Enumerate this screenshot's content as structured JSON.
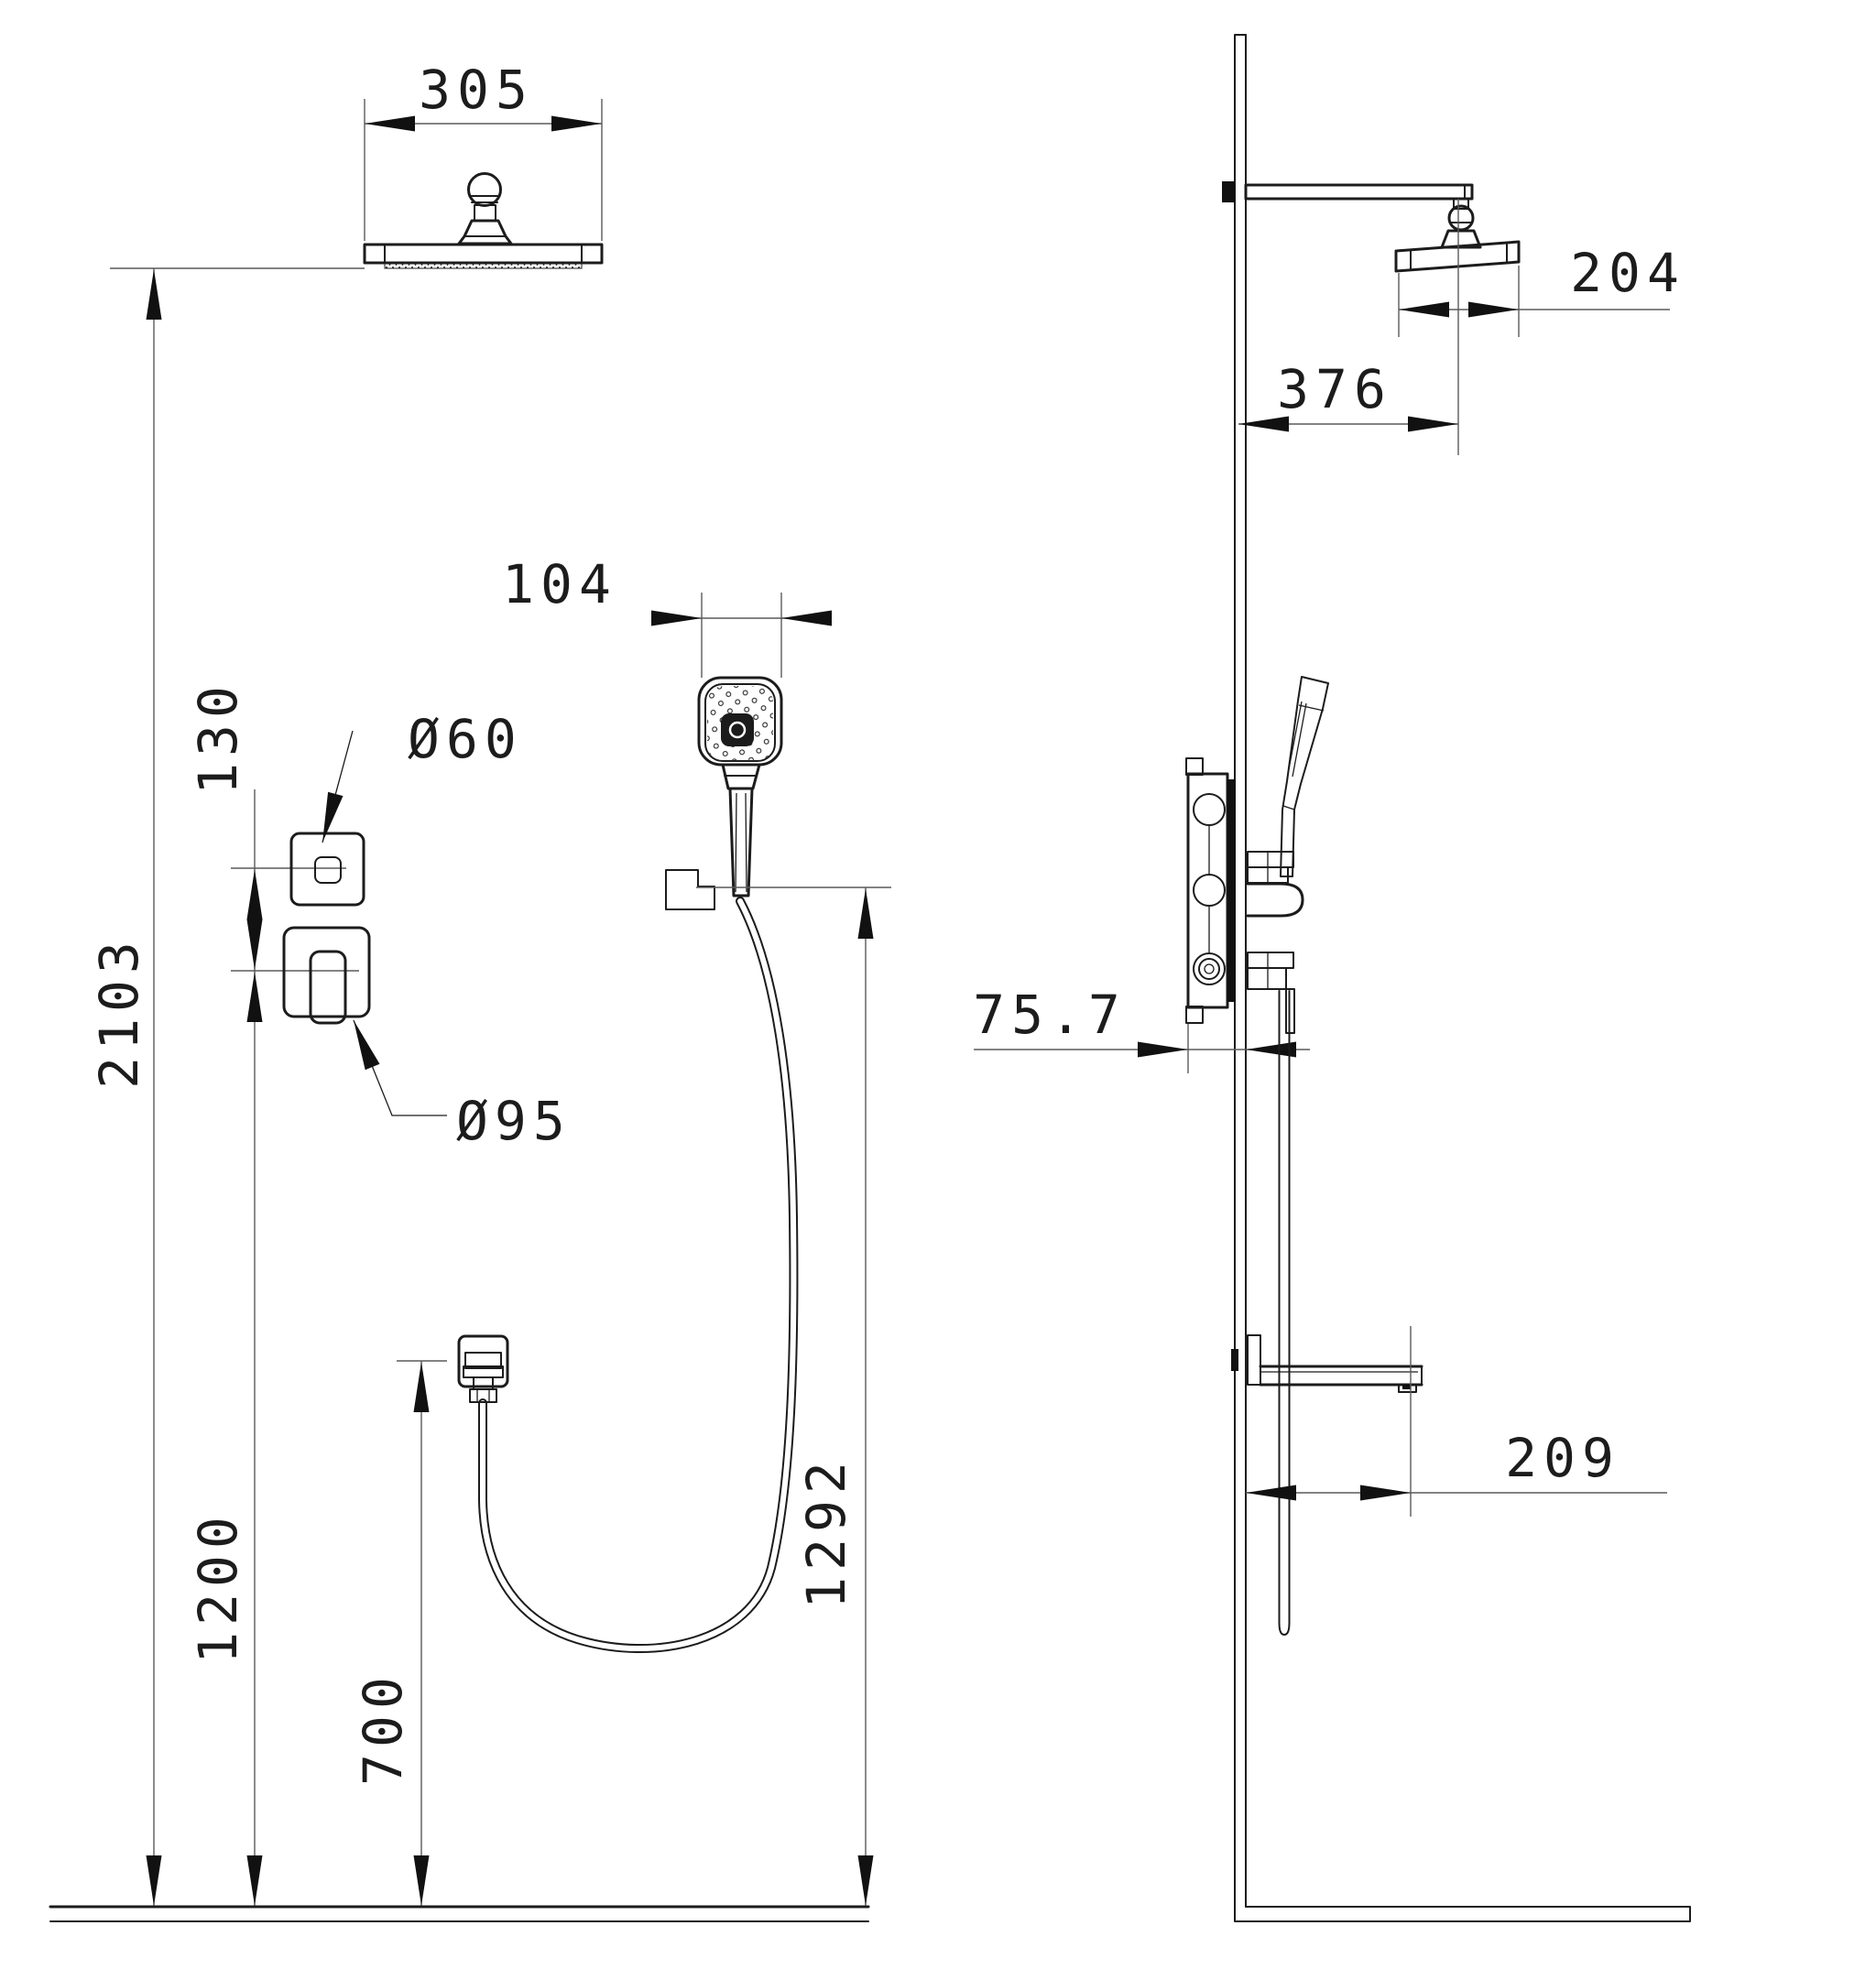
{
  "front_view": {
    "head_width": "305",
    "overall_height": "2103",
    "trim_spacing": "130",
    "diverter_label": "Ø60",
    "mixer_label": "Ø95",
    "handshower_width": "104",
    "mixer_height": "1200",
    "outlet_height": "700",
    "holder_height": "1292"
  },
  "side_view": {
    "head_depth": "204",
    "head_offset": "376",
    "valve_depth": "75.7",
    "shelf_reach": "209"
  }
}
